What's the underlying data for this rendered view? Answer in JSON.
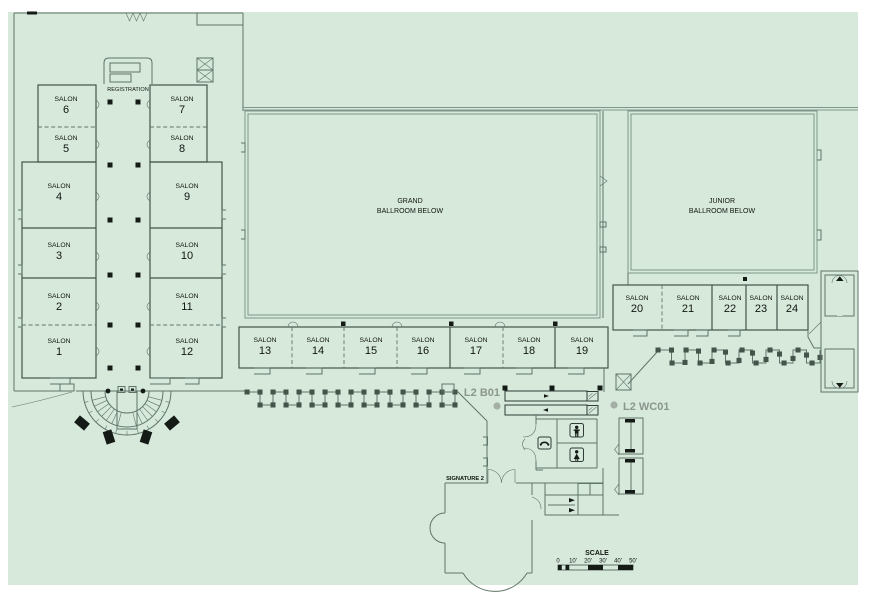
{
  "colors": {
    "floor": "#d6e9db",
    "wall": "#5e7569",
    "wall_dark": "#43544a",
    "wall_light": "#7f968a",
    "ink": "#10150f",
    "muted": "#8b968d",
    "dot": "#a4aea5",
    "black": "#141a16",
    "page": "#ffffff"
  },
  "salon_word": "SALON",
  "salon_numbers": [
    "1",
    "2",
    "3",
    "4",
    "5",
    "6",
    "7",
    "8",
    "9",
    "10",
    "11",
    "12",
    "13",
    "14",
    "15",
    "16",
    "17",
    "18",
    "19",
    "20",
    "21",
    "22",
    "23",
    "24"
  ],
  "labels": {
    "registration": "REGISTRATION",
    "grand_ballroom": [
      "GRAND",
      "BALLROOM BELOW"
    ],
    "junior_ballroom": [
      "JUNIOR",
      "BALLROOM BELOW"
    ],
    "marker_b01": "L2 B01",
    "marker_wc01": "L2 WC01",
    "signature": "SIGNATURE 2",
    "scale_title": "SCALE",
    "scale_ticks": [
      "0",
      "10'",
      "20'",
      "30'",
      "40'",
      "50'"
    ]
  },
  "icons": {
    "men_restroom": "man-figure",
    "women_restroom": "woman-figure",
    "phone": "telephone-handset",
    "elevator": "crossed-box",
    "escalator": "diagonal-steps",
    "stairs": "hatched-run"
  }
}
